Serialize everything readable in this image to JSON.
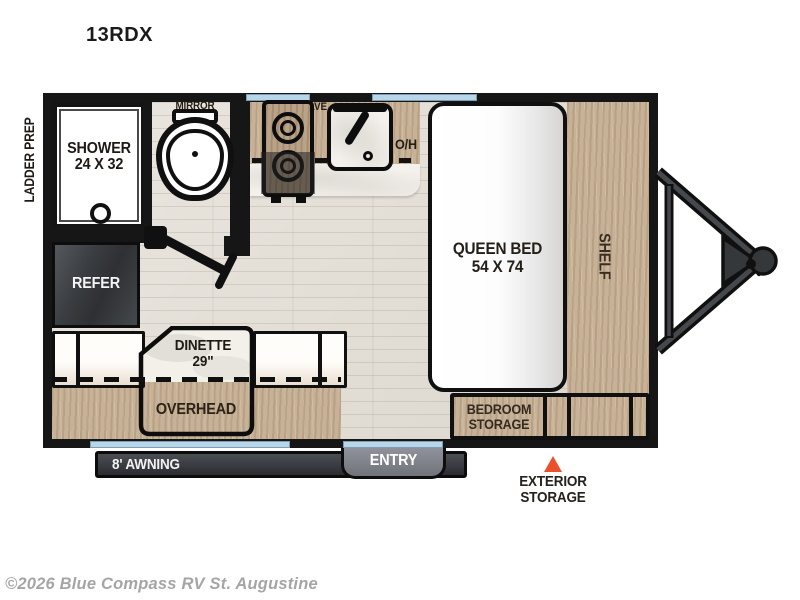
{
  "title": "13RDX",
  "labels": {
    "ladder_prep": "LADDER PREP",
    "mirror": "MIRROR",
    "shower_1": "SHOWER",
    "shower_2": "24 X 32",
    "microwave": "MICROWAVE",
    "oh": "O/H",
    "refer": "REFER",
    "queen_bed_1": "QUEEN BED",
    "queen_bed_2": "54 X 74",
    "shelf": "SHELF",
    "dinette_1": "DINETTE",
    "dinette_2": "29\"",
    "overhead": "OVERHEAD",
    "bedroom_storage_1": "BEDROOM",
    "bedroom_storage_2": "STORAGE",
    "awning": "8' AWNING",
    "entry": "ENTRY",
    "exterior_storage_1": "EXTERIOR",
    "exterior_storage_2": "STORAGE"
  },
  "footer": {
    "copyright": "©2026 Blue Compass RV St. Augustine"
  },
  "colors": {
    "wall": "#161616",
    "window": "#b8d6ea",
    "wood": "#c7b297",
    "floor": "#e4e0d8",
    "marble": "#f4f1ec",
    "refer_box": "#3a3d41",
    "awning_bar": "#2f3136",
    "entry_tab": "#85888f",
    "storage_triangle": "#e8512b",
    "copyright_text": "#a5a5a5"
  }
}
